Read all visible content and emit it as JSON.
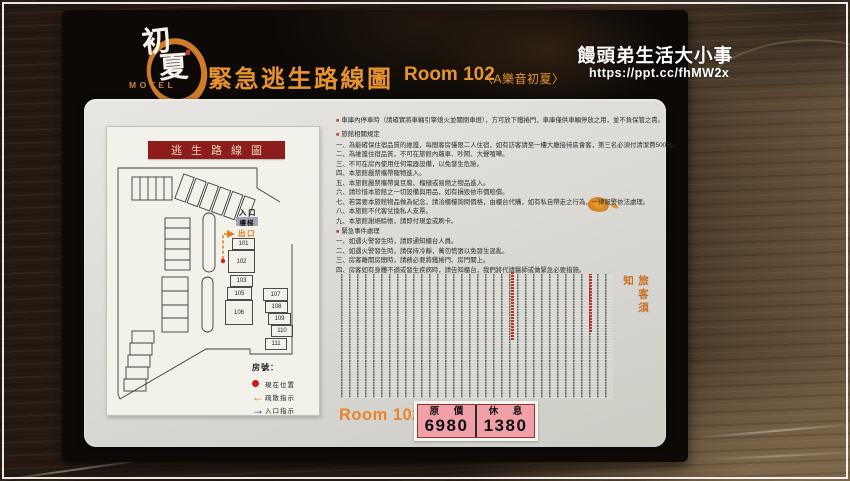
{
  "watermark": {
    "title": "饅頭弟生活大小事",
    "url": "https://ppt.cc/fhMW2x"
  },
  "plaque": {
    "logo": {
      "char1": "初",
      "char2": "夏",
      "motel": "MOTEL"
    },
    "title": "緊急逃生路線圖",
    "room": "Room 102",
    "subtitle": "〈A樂音初夏〉",
    "accent_color": "#e8932d"
  },
  "map": {
    "banner": "逃生路線圖",
    "banner_color": "#8d1c1c",
    "labels": {
      "entrance": "入口",
      "stairs": "樓梯",
      "exit": "出口"
    },
    "route_color": "#e87c1a",
    "rooms": [
      {
        "no": "101",
        "x": 126,
        "y": 112,
        "w": 23,
        "h": 12
      },
      {
        "no": "102",
        "x": 122,
        "y": 124,
        "w": 27,
        "h": 23
      },
      {
        "no": "103",
        "x": 124,
        "y": 149,
        "w": 23,
        "h": 12
      },
      {
        "no": "105",
        "x": 121,
        "y": 161,
        "w": 25,
        "h": 13
      },
      {
        "no": "106",
        "x": 119,
        "y": 174,
        "w": 28,
        "h": 25
      },
      {
        "no": "107",
        "x": 157,
        "y": 162,
        "w": 25,
        "h": 13
      },
      {
        "no": "108",
        "x": 159,
        "y": 175,
        "w": 23,
        "h": 12
      },
      {
        "no": "109",
        "x": 162,
        "y": 187,
        "w": 23,
        "h": 12
      },
      {
        "no": "110",
        "x": 165,
        "y": 199,
        "w": 22,
        "h": 12
      },
      {
        "no": "111",
        "x": 159,
        "y": 212,
        "w": 22,
        "h": 12
      }
    ],
    "legend": {
      "heading": "房號：",
      "items": [
        {
          "symbol": "red-dot",
          "label": "現在位置"
        },
        {
          "symbol": "orange-arrow-left",
          "label": "疏散指示"
        },
        {
          "symbol": "navy-arrow-right",
          "label": "入口指示"
        }
      ]
    }
  },
  "rules": {
    "garage_note": "車庫內停車時（請確實將車輛引擎熄火並關閉車燈），方可放下鐵捲門，車庫僅供車輛停放之用，並不負保管之責。",
    "hotel_heading": "旅館相關規定",
    "hotel_rules": [
      "一、為能確保住宿品質的維護，每間客房僅限二人住宿，如有訪客請至一樓大廳接待區會客，第三名必須付清潔費500元。",
      "二、為維護住宿品質，不可在旅館內飆車、吵鬧、大聲喧嘩。",
      "三、不可在房內使用任何電器設備，以免發生危險。",
      "四、本旅館嚴禁攜帶寵物進入。",
      "五、本旅館嚴禁攜帶臭豆腐、榴槤或易燃之物品進入。",
      "六、請珍惜本旅館之一切設備與用品，如有損毀依市價賠償。",
      "七、若需要本旅館物品做為紀念，請洽櫃檯詢問價格，由櫃台代購，如有私自帶走之行為，一律報警依法處理。",
      "八、本旅館不代客兌換私人支票。",
      "九、本旅館謝絕賒帳，請即付現金或刷卡。"
    ],
    "emergency_heading": "緊急事件處理",
    "emergency_rules": [
      "一、如遇火警發生時，請即通知櫃台人員。",
      "二、如遇火警發生時，請保持冷靜，萬勿慌張以免發生混亂。",
      "三、房客離開房間時，請務必要將鐵捲門、房門關上。",
      "四、房客如有身體不適或發生疾病時，請告知櫃台，我們將代請醫師或做緊急必要措施。"
    ]
  },
  "notice": {
    "title": "旅客須知",
    "illegible_column_count": 34
  },
  "price": {
    "room_label": "Room 102",
    "background_color": "#f1a0a8",
    "columns": [
      {
        "label": "原 價",
        "value": "6980"
      },
      {
        "label": "休 息",
        "value": "1380"
      }
    ]
  }
}
